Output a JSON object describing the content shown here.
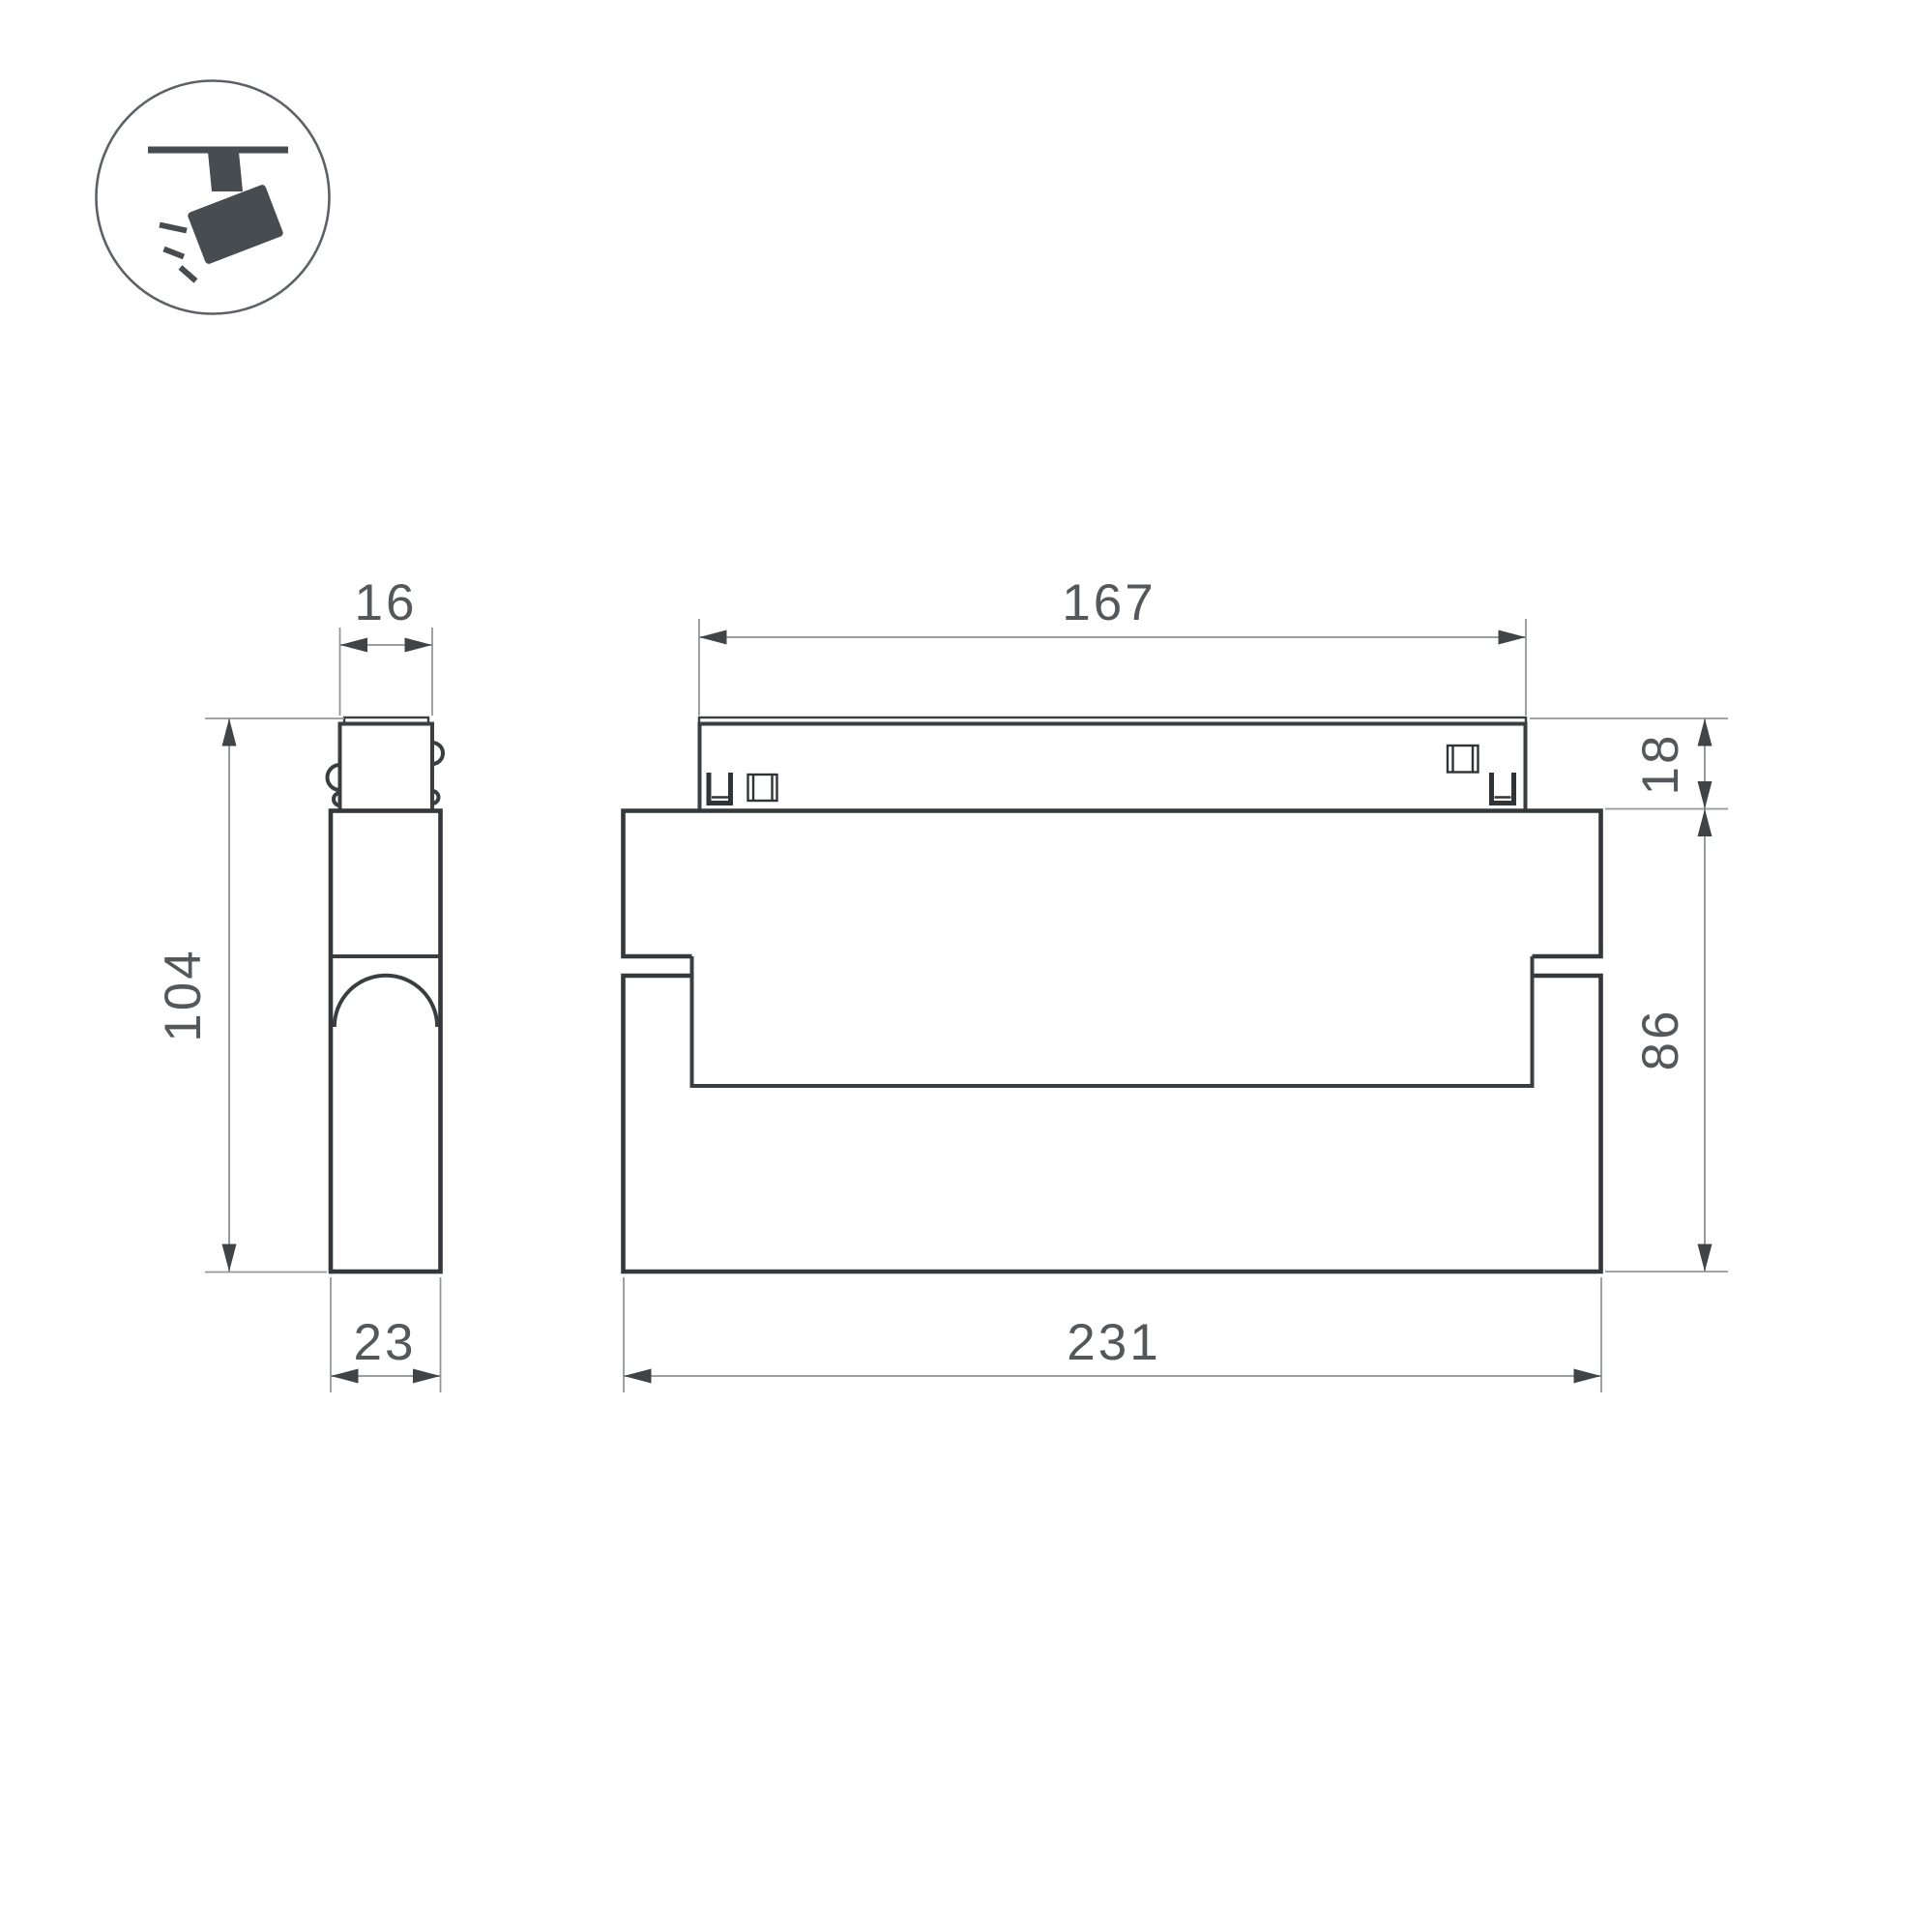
{
  "drawing": {
    "icon": {
      "name": "track-spotlight-icon"
    },
    "colors": {
      "background": "#ffffff",
      "outline": "#3a3e41",
      "dimension_lines": "#8d9093",
      "dimension_text": "#54585b",
      "icon_fill": "#474c51"
    },
    "dimensions": {
      "side_view": {
        "adapter_width": "16",
        "total_height": "104",
        "body_depth": "23"
      },
      "front_view": {
        "adapter_length": "167",
        "adapter_height": "18",
        "body_height": "86",
        "body_length": "231"
      }
    }
  }
}
